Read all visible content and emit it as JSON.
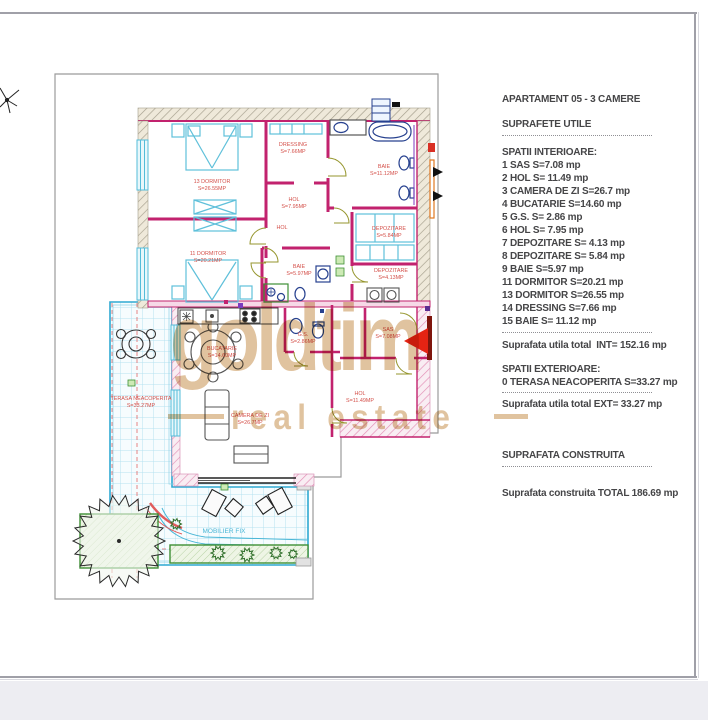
{
  "panel": {
    "lines": [
      {
        "type": "text",
        "mt": 0,
        "text": "APARTAMENT 05 - 3 CAMERE"
      },
      {
        "type": "text",
        "mt": 12,
        "text": "SUPRAFETE UTILE"
      },
      {
        "type": "dots",
        "mt": 4
      },
      {
        "type": "text",
        "mt": 8,
        "text": "SPATII INTERIOARE:"
      },
      {
        "type": "text",
        "mt": 0,
        "text": "1 SAS S=7.08 mp"
      },
      {
        "type": "text",
        "mt": 0,
        "text": "2 HOL S= 11.49 mp"
      },
      {
        "type": "text",
        "mt": 0,
        "text": "3 CAMERA DE ZI S=26.7 mp"
      },
      {
        "type": "text",
        "mt": 0,
        "text": "4 BUCATARIE S=14.60 mp"
      },
      {
        "type": "text",
        "mt": 0,
        "text": "5 G.S. S= 2.86 mp"
      },
      {
        "type": "text",
        "mt": 0,
        "text": "6 HOL S= 7.95 mp"
      },
      {
        "type": "text",
        "mt": 0,
        "text": "7 DEPOZITARE S= 4.13 mp"
      },
      {
        "type": "text",
        "mt": 0,
        "text": "8 DEPOZITARE S= 5.84 mp"
      },
      {
        "type": "text",
        "mt": 0,
        "text": "9 BAIE S=5.97 mp"
      },
      {
        "type": "text",
        "mt": 0,
        "text": "11 DORMITOR S=20.21 mp"
      },
      {
        "type": "text",
        "mt": 0,
        "text": "13 DORMITOR S=26.55 mp"
      },
      {
        "type": "text",
        "mt": 0,
        "text": "14 DRESSING S=7.66 mp"
      },
      {
        "type": "text",
        "mt": 0,
        "text": "15 BAIE S= 11.12 mp"
      },
      {
        "type": "dots",
        "mt": 4
      },
      {
        "type": "text",
        "mt": 4,
        "text": "Suprafata utila total  INT= 152.16 mp"
      },
      {
        "type": "text",
        "mt": 11,
        "text": "SPATII EXTERIOARE:"
      },
      {
        "type": "text",
        "mt": 0,
        "text": "0 TERASA NEACOPERITA S=33.27 mp"
      },
      {
        "type": "dots",
        "mt": 3
      },
      {
        "type": "text",
        "mt": 3,
        "text": "Suprafata utila total EXT= 33.27 mp"
      },
      {
        "type": "text",
        "mt": 38,
        "text": "SUPRAFATA CONSTRUITA"
      },
      {
        "type": "dots",
        "mt": 4
      },
      {
        "type": "text",
        "mt": 18,
        "text": "Suprafata construita TOTAL 186.69 mp"
      }
    ]
  },
  "watermark": {
    "line1": "goldtim",
    "line2": "real estate",
    "color": "#d8b284"
  },
  "plan": {
    "accent_colors": {
      "wall": "#c2226e",
      "label": "#d4504a",
      "terrace": "#2fa9d2",
      "green": "#3e8f35",
      "arrow": "#e42313",
      "fixture": "#27418f"
    },
    "labels": [
      {
        "n": "13 DORMITOR",
        "a": "S=26.55MP",
        "x": 212,
        "y": 183
      },
      {
        "n": "11 DORMITOR",
        "a": "S=20.21MP",
        "x": 208,
        "y": 255
      },
      {
        "n": "DRESSING",
        "a": "S=7.66MP",
        "x": 293,
        "y": 146
      },
      {
        "n": "BAIE",
        "a": "S=11.12MP",
        "x": 384,
        "y": 168
      },
      {
        "n": "HOL",
        "a": "S=7.95MP",
        "x": 294,
        "y": 201
      },
      {
        "n": "HOL",
        "a": "",
        "x": 282,
        "y": 229
      },
      {
        "n": "DEPOZITARE",
        "a": "S=5.84MP",
        "x": 389,
        "y": 230
      },
      {
        "n": "DEPOZITARE",
        "a": "S=4.13MP",
        "x": 391,
        "y": 272
      },
      {
        "n": "BAIE",
        "a": "S=5.97MP",
        "x": 299,
        "y": 268
      },
      {
        "n": "G.S.",
        "a": "S=2.86MP",
        "x": 303,
        "y": 336
      },
      {
        "n": "SAS",
        "a": "S=7.08MP",
        "x": 388,
        "y": 331
      },
      {
        "n": "HOL",
        "a": "S=11.49MP",
        "x": 360,
        "y": 395
      },
      {
        "n": "BUCATARIE",
        "a": "S=14.60MP",
        "x": 222,
        "y": 350
      },
      {
        "n": "CAMERA DE ZI",
        "a": "S=26.7MP",
        "x": 250,
        "y": 417
      },
      {
        "n": "TERASA NEACOPERITA",
        "a": "S=33.27MP",
        "x": 141,
        "y": 400
      },
      {
        "n": "MOBILIER FIX",
        "a": "",
        "x": 224,
        "y": 533,
        "c": "#49b6d6",
        "s": 6.5
      }
    ]
  }
}
